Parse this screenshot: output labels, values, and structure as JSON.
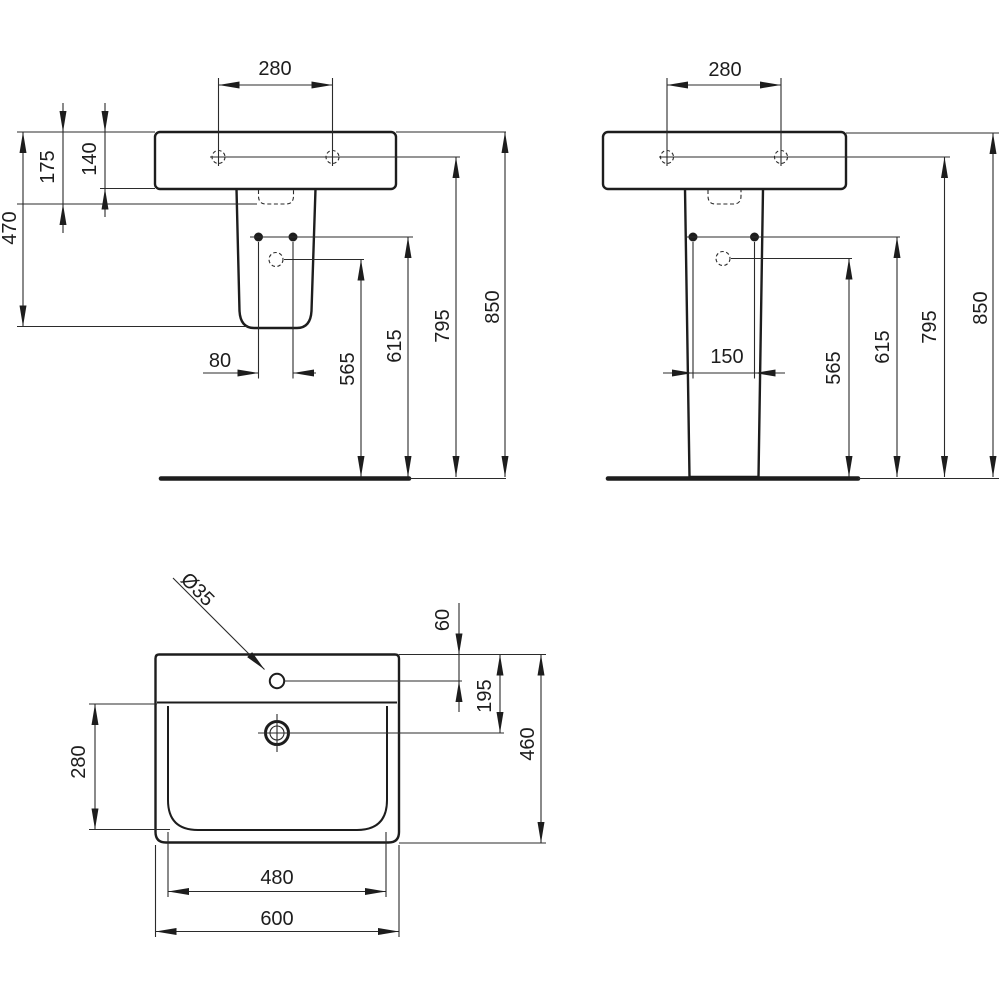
{
  "views": {
    "front_semi_pedestal": {
      "dims": {
        "tap_hole_spacing": "280",
        "basin_height": "140",
        "basin_to_cutout": "175",
        "basin_overall_drop": "470",
        "fixing_hole_spacing": "80",
        "outlet_height": "565",
        "fixing_height": "615",
        "tap_hole_height": "795",
        "rim_height": "850"
      }
    },
    "front_full_pedestal": {
      "dims": {
        "tap_hole_spacing": "280",
        "fixing_hole_spacing": "150",
        "outlet_height": "565",
        "fixing_height": "615",
        "tap_hole_height": "795",
        "rim_height": "850"
      }
    },
    "plan": {
      "dims": {
        "tap_hole_diameter": "Ø35",
        "tap_hole_from_back": "60",
        "drain_from_back": "195",
        "overall_depth": "460",
        "bowl_depth": "280",
        "bowl_width": "480",
        "overall_width": "600"
      }
    }
  }
}
